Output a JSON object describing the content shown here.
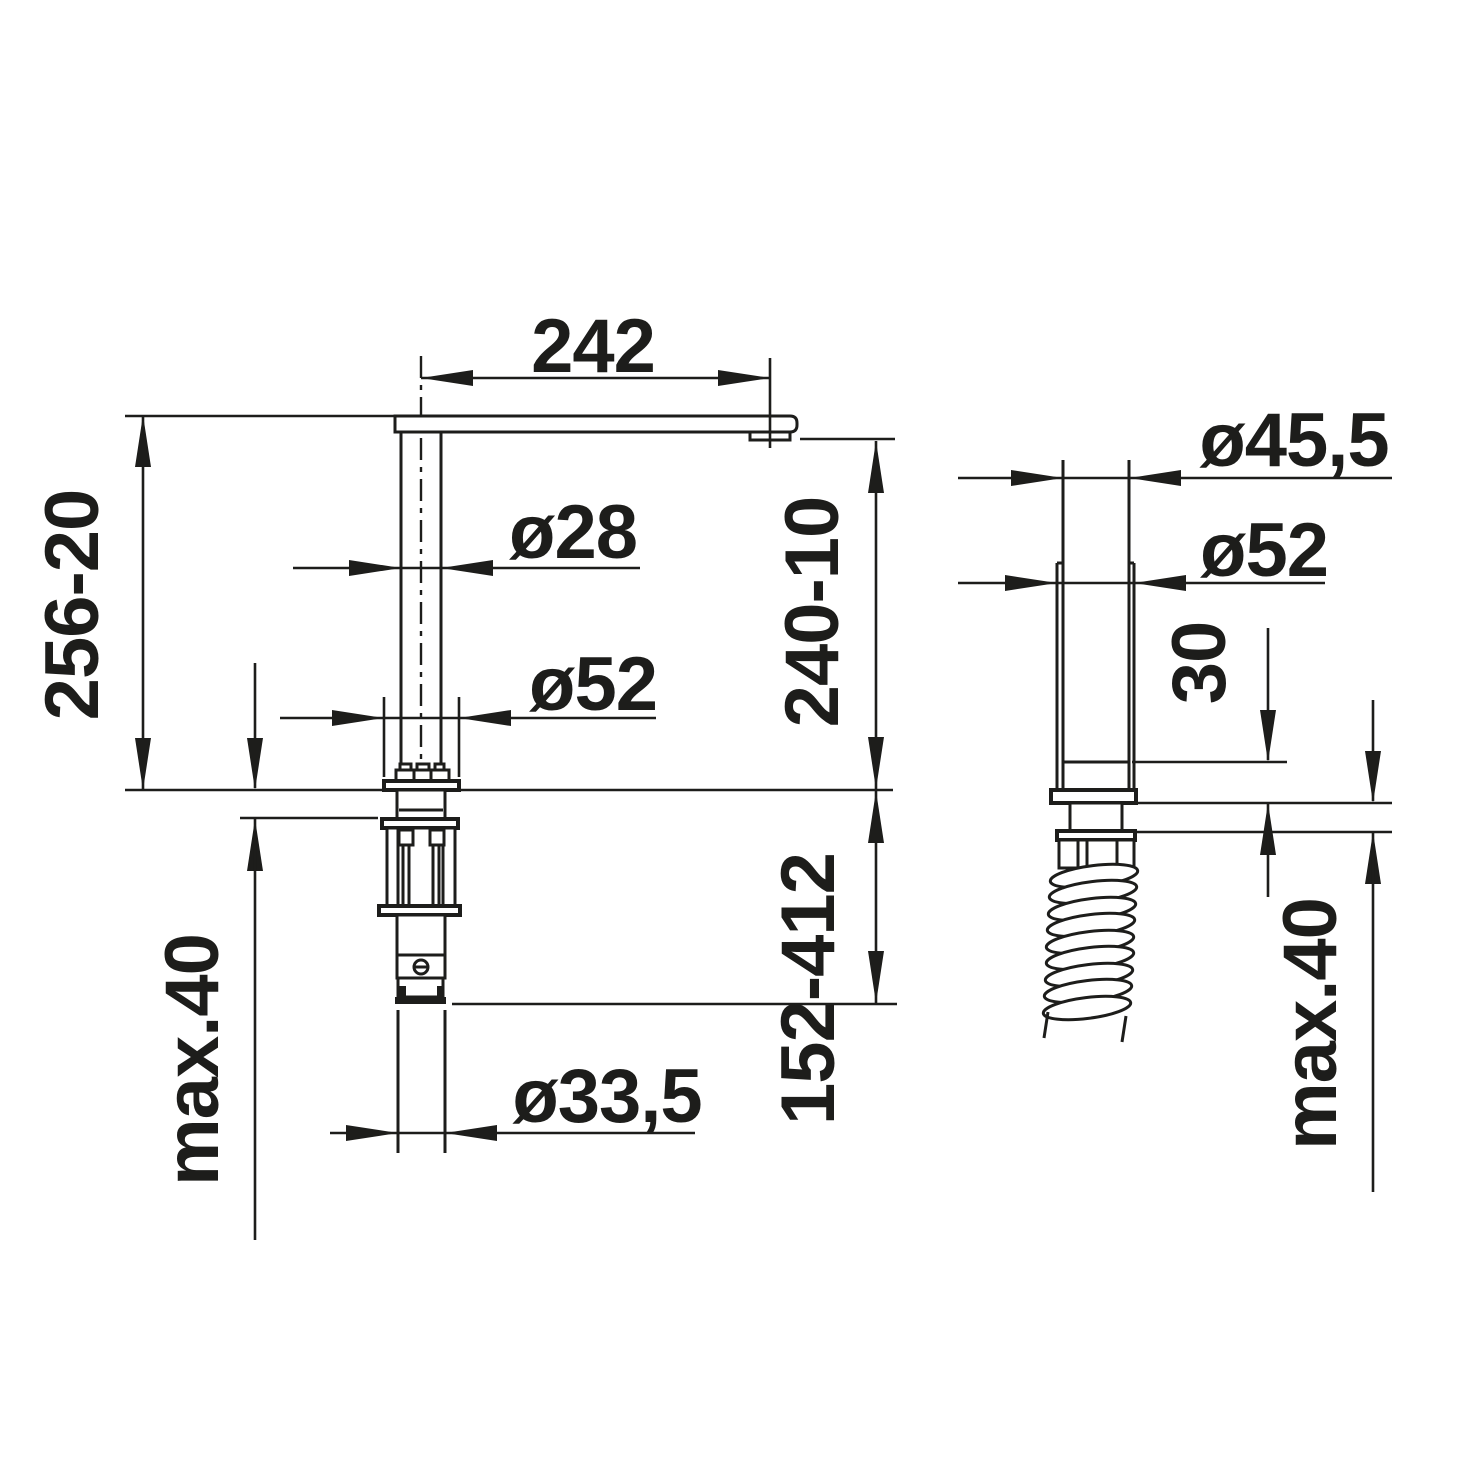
{
  "drawing": {
    "type": "installation dimension drawing",
    "views": [
      "side view of tap",
      "front view of under-counter hose guide"
    ]
  },
  "colors": {
    "ink": "#1d1d1b",
    "background": "#ffffff"
  },
  "side_view": {
    "spout_reach": "242",
    "pipe_diameter": "ø28",
    "escutcheon_diameter": "ø52",
    "height_range": "256-20",
    "outlet_height_range": "240-10",
    "max_counter_thickness": "max.40",
    "shank_hose_diameter": "ø33,5",
    "below_counter_range": "152-412"
  },
  "front_view": {
    "guide_inner_diameter": "ø45,5",
    "guide_outer_diameter": "ø52",
    "flange_offset": "30",
    "max_counter_thickness": "max.40"
  }
}
